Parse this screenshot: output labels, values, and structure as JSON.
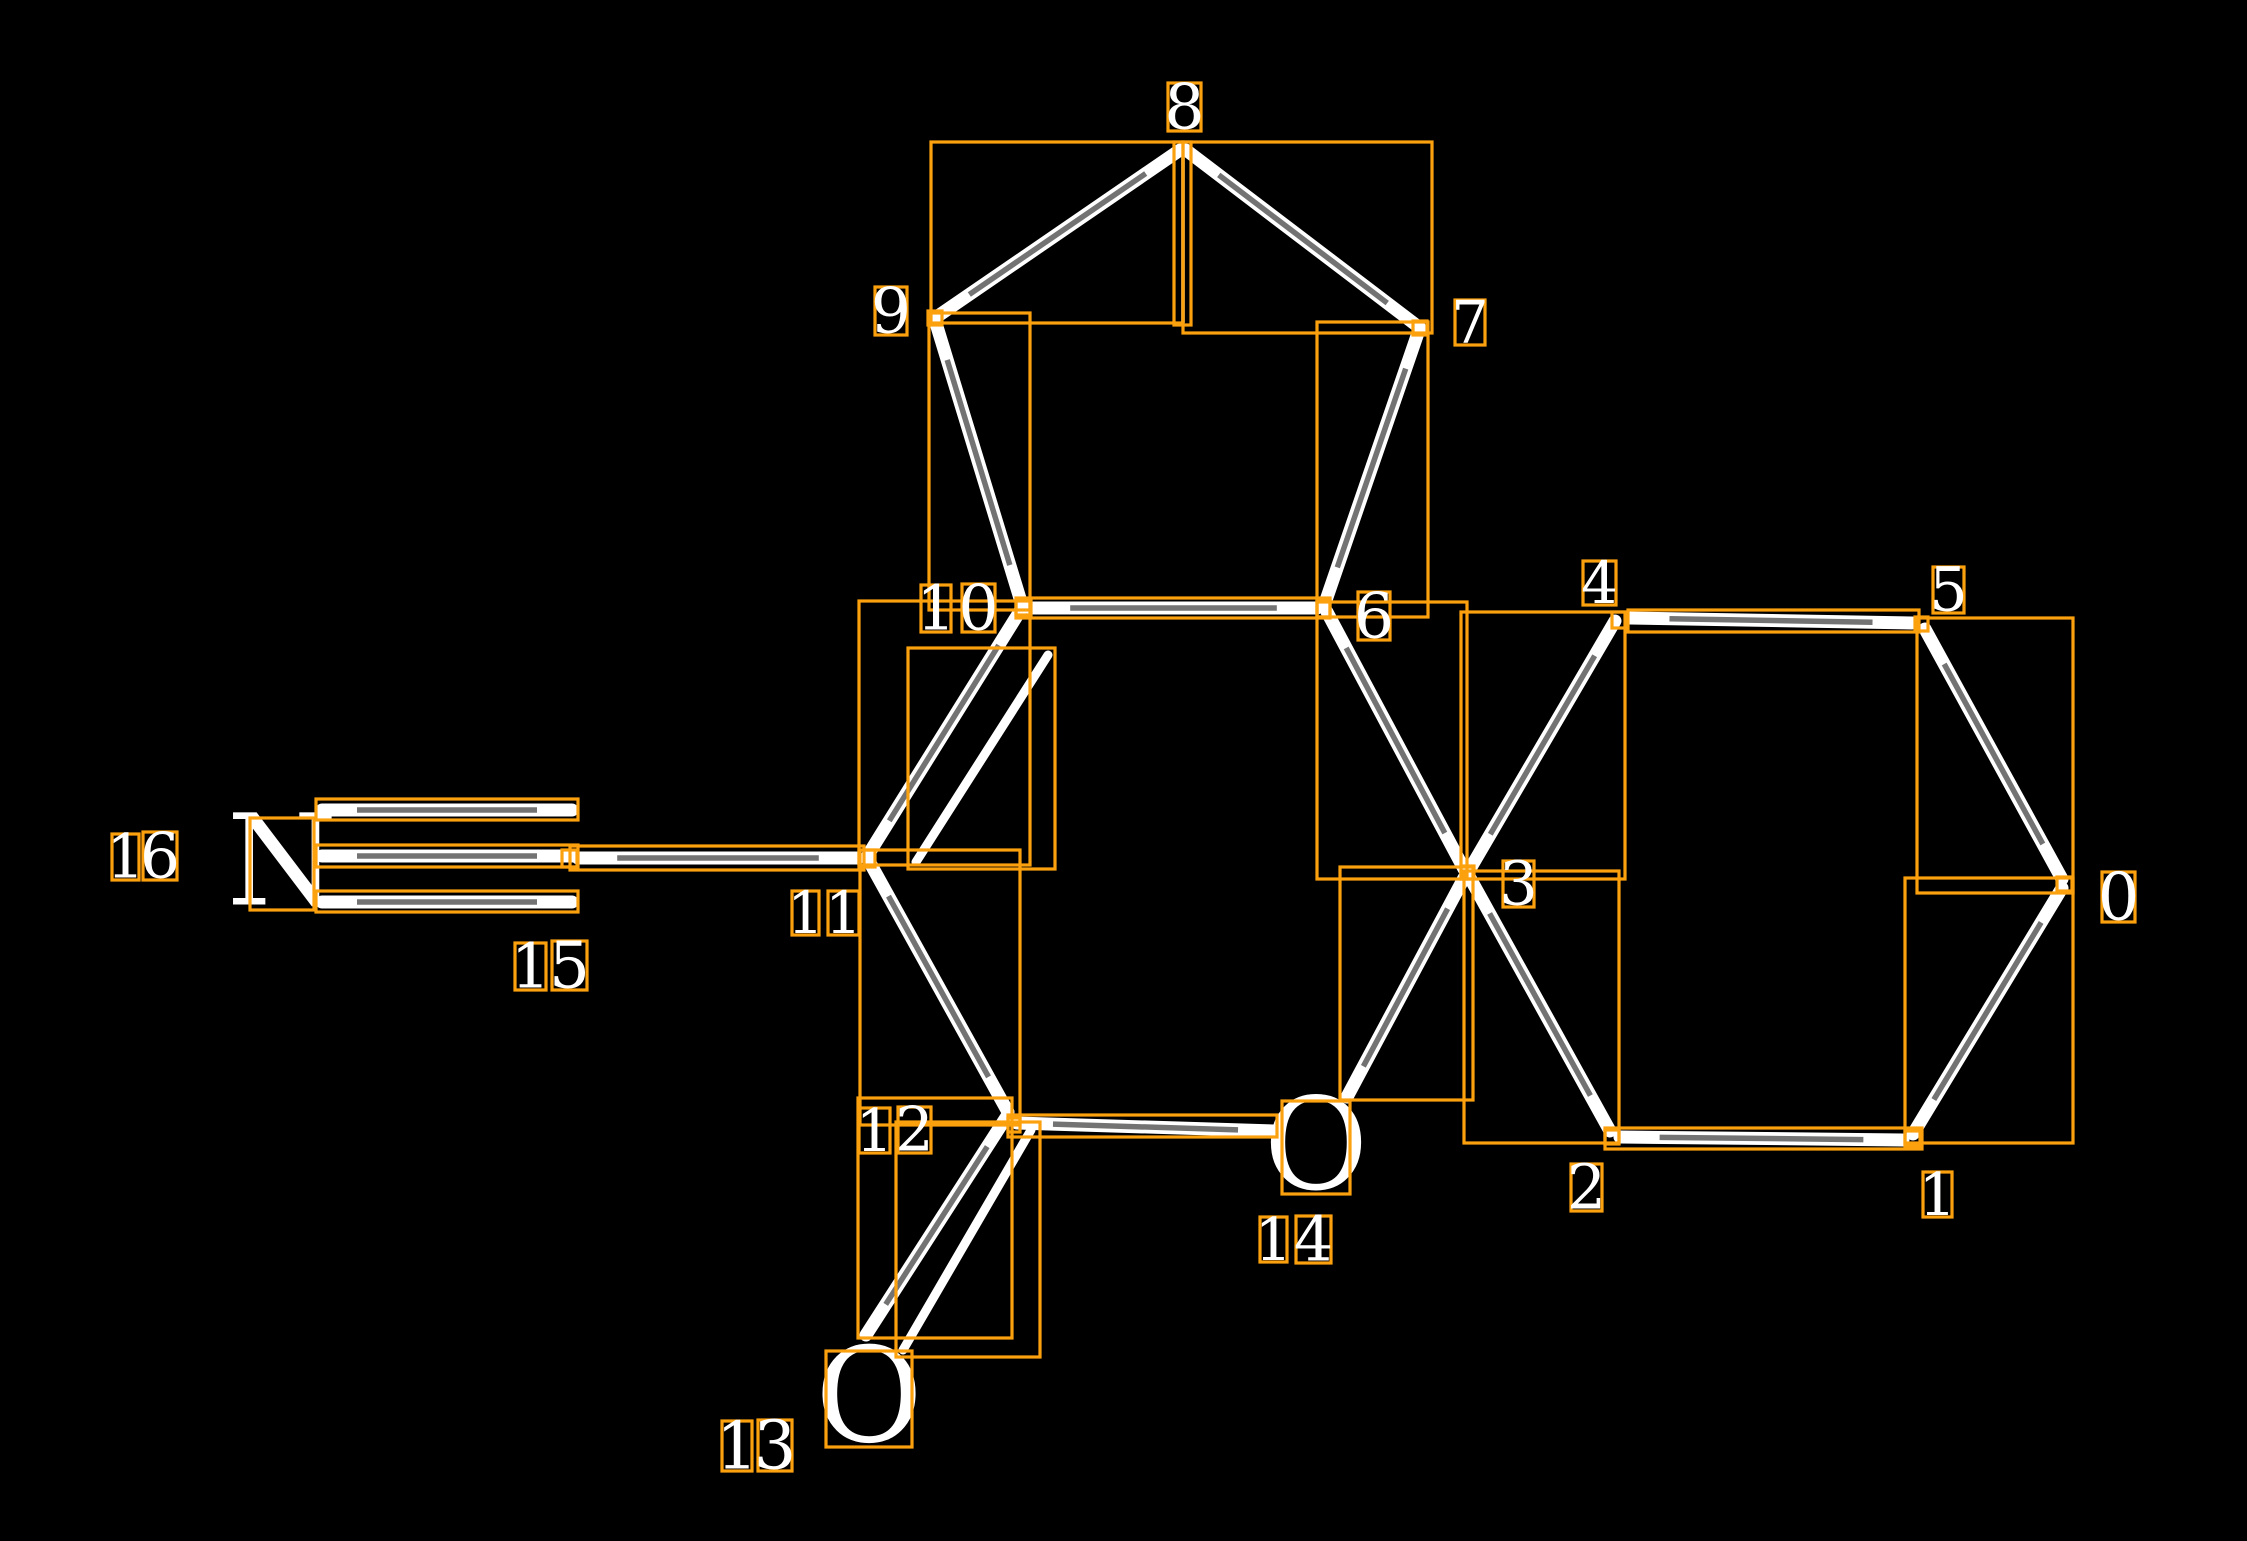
{
  "scene": {
    "width": 2247,
    "height": 1541,
    "background": "#000000"
  },
  "colors": {
    "annotation": "#FCA10E",
    "bond": "#FFFFFF",
    "bond_core": "#000000",
    "glyph": "#FFFFFF"
  },
  "stroke": {
    "box_width": 3.2,
    "bond_width": 13,
    "inner_bond_width": 9,
    "thin_bond_width": 3.5,
    "core_width": 5.5,
    "core_opacity": 0.55,
    "core_trim": 0.14
  },
  "molecule": {
    "hetero_atoms": [
      {
        "symbol": "N",
        "box": [
          250,
          818,
          64,
          92
        ]
      },
      {
        "symbol": "O",
        "box": [
          1282,
          1101,
          68,
          93
        ]
      },
      {
        "symbol": "O",
        "box": [
          826,
          1351,
          86,
          96
        ]
      }
    ],
    "index_labels": [
      {
        "text": "0",
        "digits": [
          {
            "ch": "0",
            "box": [
              2102,
              872,
              33,
              50
            ]
          }
        ]
      },
      {
        "text": "1",
        "digits": [
          {
            "ch": "1",
            "box": [
              1923,
              1172,
              29,
              45
            ]
          }
        ]
      },
      {
        "text": "2",
        "digits": [
          {
            "ch": "2",
            "box": [
              1571,
              1164,
              31,
              47
            ]
          }
        ]
      },
      {
        "text": "3",
        "digits": [
          {
            "ch": "3",
            "box": [
              1503,
              861,
              31,
              46
            ]
          }
        ]
      },
      {
        "text": "4",
        "digits": [
          {
            "ch": "4",
            "box": [
              1583,
              561,
              33,
              44
            ]
          }
        ]
      },
      {
        "text": "5",
        "digits": [
          {
            "ch": "5",
            "box": [
              1933,
              567,
              31,
              46
            ]
          }
        ]
      },
      {
        "text": "6",
        "digits": [
          {
            "ch": "6",
            "box": [
              1358,
              592,
              32,
              48
            ]
          }
        ]
      },
      {
        "text": "7",
        "digits": [
          {
            "ch": "7",
            "box": [
              1455,
              300,
              30,
              45
            ]
          }
        ]
      },
      {
        "text": "8",
        "digits": [
          {
            "ch": "8",
            "box": [
              1168,
              83,
              33,
              48
            ]
          }
        ]
      },
      {
        "text": "9",
        "digits": [
          {
            "ch": "9",
            "box": [
              875,
              287,
              32,
              48
            ]
          }
        ]
      },
      {
        "text": "10",
        "digits": [
          {
            "ch": "1",
            "box": [
              921,
              585,
              30,
              47
            ]
          },
          {
            "ch": "0",
            "box": [
              962,
              584,
              33,
              48
            ]
          }
        ]
      },
      {
        "text": "11",
        "digits": [
          {
            "ch": "1",
            "box": [
              792,
              891,
              27,
              44
            ]
          },
          {
            "ch": "1",
            "box": [
              828,
              891,
              31,
              44
            ]
          }
        ]
      },
      {
        "text": "12",
        "digits": [
          {
            "ch": "1",
            "box": [
              859,
              1108,
              31,
              45
            ]
          },
          {
            "ch": "2",
            "box": [
              898,
              1107,
              33,
              46
            ]
          }
        ]
      },
      {
        "text": "13",
        "digits": [
          {
            "ch": "1",
            "box": [
              722,
              1421,
              30,
              50
            ]
          },
          {
            "ch": "3",
            "box": [
              758,
              1420,
              34,
              51
            ]
          }
        ]
      },
      {
        "text": "14",
        "digits": [
          {
            "ch": "1",
            "box": [
              1260,
              1217,
              27,
              45
            ]
          },
          {
            "ch": "4",
            "box": [
              1296,
              1216,
              35,
              47
            ]
          }
        ]
      },
      {
        "text": "15",
        "digits": [
          {
            "ch": "1",
            "box": [
              515,
              943,
              31,
              47
            ]
          },
          {
            "ch": "5",
            "box": [
              552,
              941,
              35,
              49
            ]
          }
        ]
      },
      {
        "text": "16",
        "digits": [
          {
            "ch": "1",
            "box": [
              112,
              834,
              27,
              46
            ]
          },
          {
            "ch": "6",
            "box": [
              143,
              832,
              34,
              48
            ]
          }
        ]
      }
    ],
    "atom_markers": [
      [
        562,
        850,
        15,
        17
      ],
      [
        859,
        850,
        16,
        17
      ],
      [
        1016,
        600,
        15,
        15
      ],
      [
        1317,
        600,
        13,
        17
      ],
      [
        1461,
        866,
        13,
        13
      ],
      [
        1612,
        612,
        15,
        16
      ],
      [
        1915,
        617,
        13,
        14
      ],
      [
        2057,
        877,
        15,
        14
      ],
      [
        1905,
        1131,
        15,
        15
      ],
      [
        1605,
        1130,
        14,
        14
      ],
      [
        1008,
        1118,
        12,
        14
      ],
      [
        928,
        311,
        14,
        14
      ],
      [
        1413,
        321,
        14,
        14
      ]
    ],
    "bond_boxes": [
      {
        "name": "bond-9-8",
        "box": [
          931,
          142,
          252,
          181
        ]
      },
      {
        "name": "bond-8-7",
        "box": [
          1183,
          142,
          249,
          191
        ]
      },
      {
        "name": "bond-8-bridge",
        "box": [
          1174,
          142,
          17,
          183
        ]
      },
      {
        "name": "bond-9-10",
        "box": [
          929,
          313,
          101,
          297
        ]
      },
      {
        "name": "bond-7-6",
        "box": [
          1317,
          322,
          111,
          295
        ]
      },
      {
        "name": "bond-10-6",
        "box": [
          1016,
          598,
          314,
          20
        ]
      },
      {
        "name": "bond-10-11-main",
        "box": [
          859,
          601,
          171,
          264
        ]
      },
      {
        "name": "bond-10-11-inner",
        "box": [
          908,
          648,
          147,
          221
        ]
      },
      {
        "name": "bond-15-11",
        "box": [
          570,
          846,
          294,
          24
        ]
      },
      {
        "name": "triple-top",
        "box": [
          316,
          799,
          262,
          21
        ]
      },
      {
        "name": "triple-mid",
        "box": [
          316,
          845,
          262,
          22
        ]
      },
      {
        "name": "triple-bottom",
        "box": [
          316,
          891,
          262,
          21
        ]
      },
      {
        "name": "bond-11-12",
        "box": [
          860,
          850,
          160,
          275
        ]
      },
      {
        "name": "bond-12-14",
        "box": [
          1008,
          1115,
          269,
          22
        ]
      },
      {
        "name": "bond-12-13-main",
        "box": [
          858,
          1098,
          154,
          240
        ]
      },
      {
        "name": "bond-12-13-inner",
        "box": [
          896,
          1122,
          144,
          235
        ]
      },
      {
        "name": "bond-6-3",
        "box": [
          1317,
          602,
          150,
          277
        ]
      },
      {
        "name": "bond-3-4",
        "box": [
          1461,
          612,
          164,
          267
        ]
      },
      {
        "name": "bond-4-5",
        "box": [
          1628,
          610,
          291,
          22
        ]
      },
      {
        "name": "bond-5-0",
        "box": [
          1917,
          618,
          156,
          275
        ]
      },
      {
        "name": "bond-0-1",
        "box": [
          1905,
          878,
          168,
          265
        ]
      },
      {
        "name": "bond-1-2",
        "box": [
          1605,
          1128,
          317,
          21
        ]
      },
      {
        "name": "bond-2-3",
        "box": [
          1464,
          871,
          155,
          272
        ]
      },
      {
        "name": "bond-3-14",
        "box": [
          1340,
          867,
          133,
          233
        ]
      }
    ],
    "bonds": [
      {
        "name": "bond-9-8",
        "line": [
          935,
          318,
          1180,
          150
        ],
        "type": "tube"
      },
      {
        "name": "bond-8-7",
        "line": [
          1186,
          150,
          1420,
          328
        ],
        "type": "tube"
      },
      {
        "name": "bond-8-bridge",
        "line": [
          1183,
          152,
          1183,
          322
        ],
        "type": "thin"
      },
      {
        "name": "bond-9-10",
        "line": [
          935,
          320,
          1022,
          605
        ],
        "type": "tube"
      },
      {
        "name": "bond-7-6",
        "line": [
          1419,
          330,
          1324,
          606
        ],
        "type": "tube"
      },
      {
        "name": "bond-10-6",
        "line": [
          1030,
          608,
          1317,
          608
        ],
        "type": "tube"
      },
      {
        "name": "bond-10-11-main",
        "line": [
          1020,
          611,
          868,
          855
        ],
        "type": "tube"
      },
      {
        "name": "bond-10-11-inner",
        "line": [
          1048,
          655,
          916,
          862
        ],
        "type": "plain"
      },
      {
        "name": "bond-15-11",
        "line": [
          578,
          858,
          858,
          858
        ],
        "type": "tube"
      },
      {
        "name": "triple-top",
        "line": [
          322,
          810,
          572,
          810
        ],
        "type": "tube"
      },
      {
        "name": "triple-mid",
        "line": [
          322,
          856,
          572,
          856
        ],
        "type": "tube"
      },
      {
        "name": "triple-bottom",
        "line": [
          322,
          902,
          572,
          902
        ],
        "type": "tube"
      },
      {
        "name": "bond-11-12",
        "line": [
          869,
          861,
          1008,
          1112
        ],
        "type": "tube"
      },
      {
        "name": "bond-12-14",
        "line": [
          1017,
          1123,
          1274,
          1131
        ],
        "type": "tube"
      },
      {
        "name": "bond-12-13-main",
        "line": [
          1007,
          1116,
          866,
          1335
        ],
        "type": "tube"
      },
      {
        "name": "bond-12-13-inner",
        "line": [
          1031,
          1130,
          903,
          1350
        ],
        "type": "plain"
      },
      {
        "name": "bond-6-3",
        "line": [
          1327,
          612,
          1464,
          869
        ],
        "type": "tube"
      },
      {
        "name": "bond-3-4",
        "line": [
          1470,
          869,
          1615,
          621
        ],
        "type": "tube"
      },
      {
        "name": "bond-4-5",
        "line": [
          1630,
          618,
          1912,
          623
        ],
        "type": "tube"
      },
      {
        "name": "bond-5-0",
        "line": [
          1925,
          629,
          2062,
          879
        ],
        "type": "tube"
      },
      {
        "name": "bond-0-1",
        "line": [
          2062,
          888,
          1913,
          1134
        ],
        "type": "tube"
      },
      {
        "name": "bond-1-2",
        "line": [
          1903,
          1140,
          1620,
          1137
        ],
        "type": "tube"
      },
      {
        "name": "bond-2-3",
        "line": [
          1610,
          1131,
          1470,
          878
        ],
        "type": "tube"
      },
      {
        "name": "bond-3-14",
        "line": [
          1464,
          878,
          1347,
          1097
        ],
        "type": "tube"
      }
    ]
  }
}
